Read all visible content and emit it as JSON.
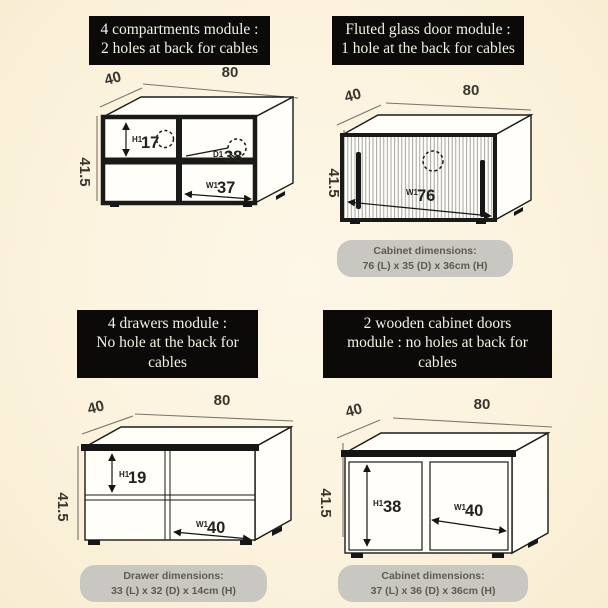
{
  "colors": {
    "background": "#fcf3de",
    "title_bg": "#0b0a08",
    "title_fg": "#f6f1e4",
    "pill_bg": "#c8c7c2",
    "pill_fg": "#5f5a50",
    "line": "#1a1a18"
  },
  "modules": {
    "compartments": {
      "title": [
        "4 compartments module :",
        "2 holes at back for cables"
      ],
      "depth": "40",
      "width": "80",
      "height": "41.5",
      "h1_prefix": "H1",
      "h1": "17",
      "d1_prefix": "D1",
      "d1": "38",
      "w1_prefix": "W1",
      "w1": "37"
    },
    "fluted": {
      "title": [
        "Fluted glass door module :",
        "1 hole at the back for cables"
      ],
      "depth": "40",
      "width": "80",
      "height": "41.5",
      "w1_prefix": "W1",
      "w1": "76",
      "pill": {
        "label": "Cabinet dimensions:",
        "value": "76 (L) x 35 (D) x 36cm (H)"
      }
    },
    "drawers": {
      "title": [
        "4 drawers module :",
        "No hole at the back for",
        "cables"
      ],
      "depth": "40",
      "width": "80",
      "height": "41.5",
      "h1_prefix": "H1",
      "h1": "19",
      "w1_prefix": "W1",
      "w1": "40",
      "pill": {
        "label": "Drawer dimensions:",
        "value": "33 (L) x 32 (D) x 14cm (H)"
      }
    },
    "doors": {
      "title": [
        "2 wooden cabinet doors",
        "module : no holes at back for",
        "cables"
      ],
      "depth": "40",
      "width": "80",
      "height": "41.5",
      "h1_prefix": "H1",
      "h1": "38",
      "w1_prefix": "W1",
      "w1": "40",
      "pill": {
        "label": "Cabinet dimensions:",
        "value": "37 (L) x 36 (D) x 36cm (H)"
      }
    }
  }
}
